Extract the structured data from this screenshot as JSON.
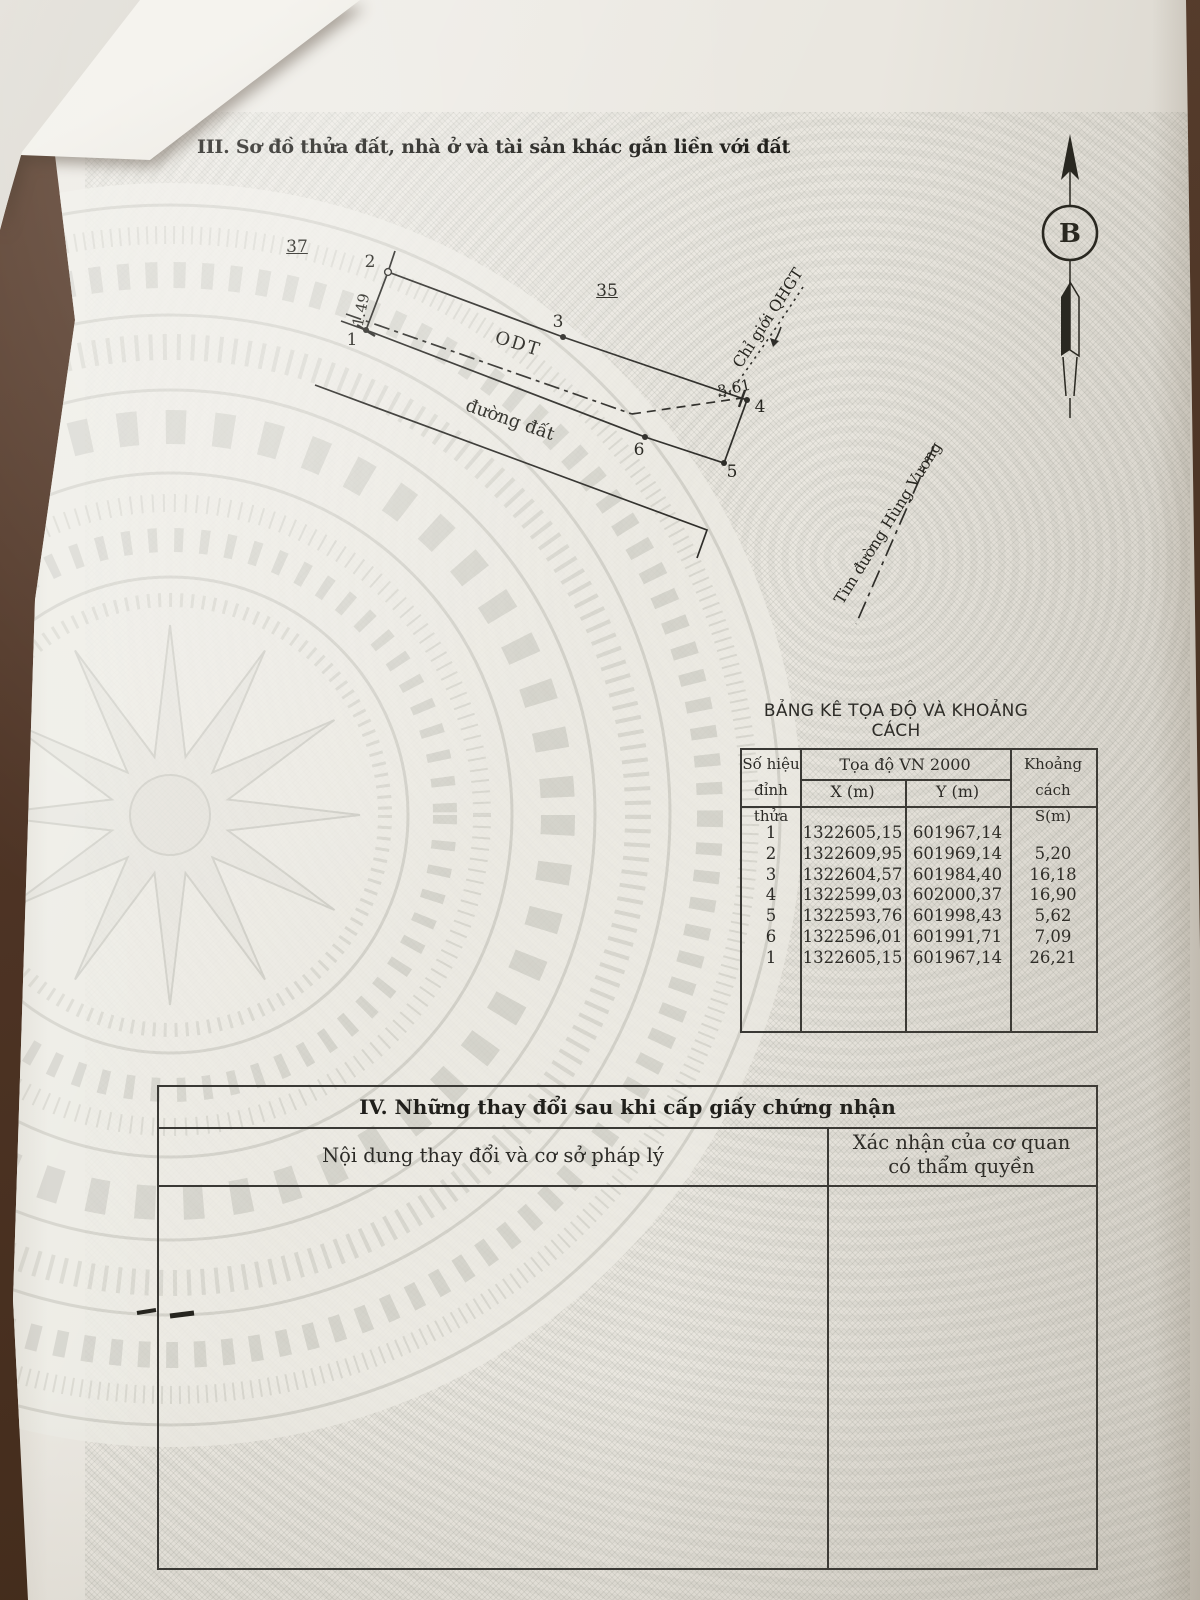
{
  "page": {
    "section3_title": "III. Sơ đồ thửa đất, nhà ở và tài sản khác gắn liền với đất"
  },
  "diagram": {
    "adjacent_parcel_left": "37",
    "adjacent_parcel_top": "35",
    "land_use_code": "ODT",
    "road_label": "đường đất",
    "planning_boundary_label": "Chỉ giới QHGT",
    "road_centerline_label": "Tim đường Hùng Vương",
    "north_label": "B",
    "vertices": [
      "1",
      "2",
      "3",
      "4",
      "5",
      "6"
    ],
    "measurements": {
      "edge_1_2": "1.49",
      "near_vertex_4": "3.61"
    }
  },
  "coord_table": {
    "title": "BẢNG KÊ TỌA ĐỘ VÀ KHOẢNG CÁCH",
    "headers": {
      "vertex_line1": "Số hiệu",
      "vertex_line2": "đỉnh thửa",
      "coords": "Tọa độ VN 2000",
      "x": "X (m)",
      "y": "Y (m)",
      "distance_line1": "Khoảng cách",
      "distance_line2": "S(m)"
    },
    "rows": [
      {
        "id": "1",
        "x": "1322605,15",
        "y": "601967,14",
        "s": ""
      },
      {
        "id": "2",
        "x": "1322609,95",
        "y": "601969,14",
        "s": "5,20"
      },
      {
        "id": "3",
        "x": "1322604,57",
        "y": "601984,40",
        "s": "16,18"
      },
      {
        "id": "4",
        "x": "1322599,03",
        "y": "602000,37",
        "s": "16,90"
      },
      {
        "id": "5",
        "x": "1322593,76",
        "y": "601998,43",
        "s": "5,62"
      },
      {
        "id": "6",
        "x": "1322596,01",
        "y": "601991,71",
        "s": "7,09"
      },
      {
        "id": "1",
        "x": "1322605,15",
        "y": "601967,14",
        "s": "26,21"
      }
    ]
  },
  "section4": {
    "title": "IV. Những thay đổi sau khi cấp giấy chứng nhận",
    "col1": "Nội dung thay đổi và cơ sở pháp lý",
    "col2_line1": "Xác nhận của cơ quan",
    "col2_line2": "có thẩm quyền"
  },
  "colors": {
    "paper": "#eae7e0",
    "line_ink": "#2e2d29",
    "table_surface": "#4e3425",
    "watermark": "#d2d1c9"
  }
}
